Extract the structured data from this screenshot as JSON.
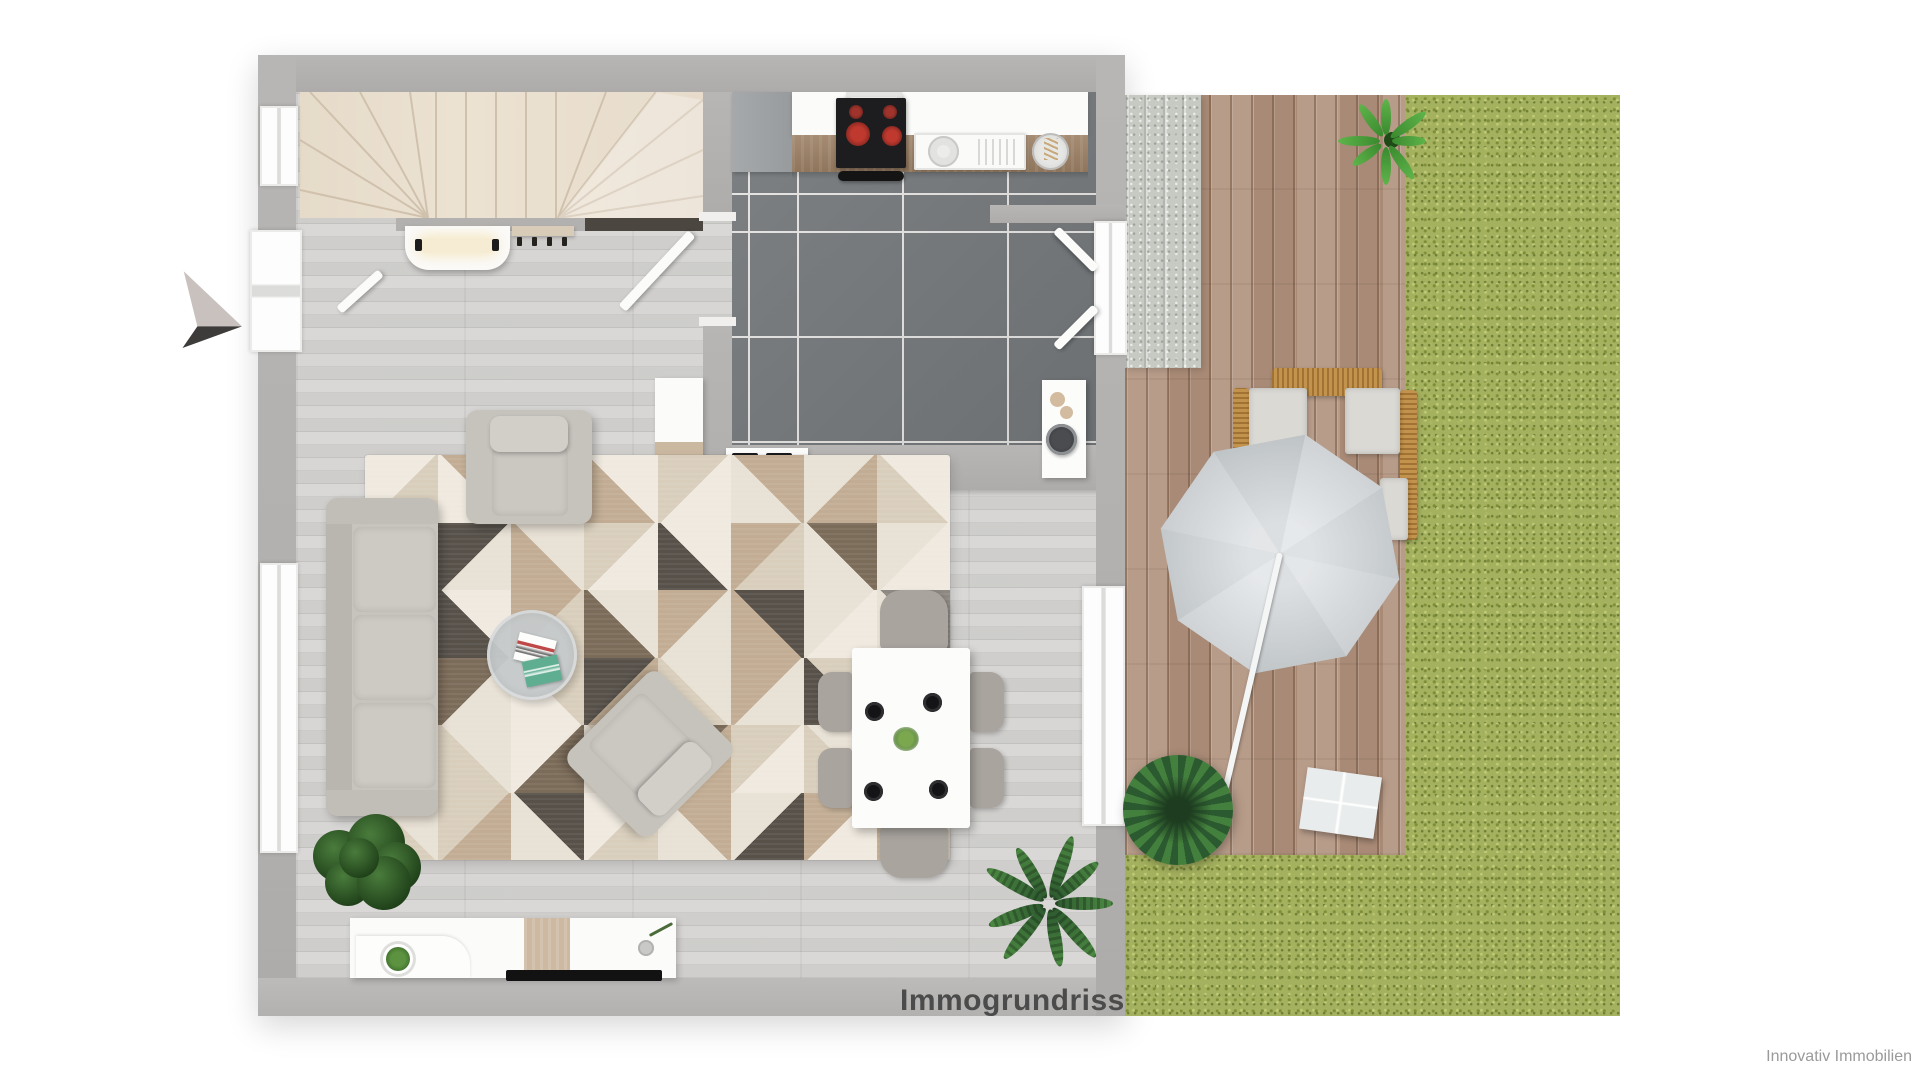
{
  "watermark": {
    "label": "Immogrundriss",
    "color": "#4b4b4b"
  },
  "branding": {
    "label": "Innovativ Immobilien",
    "color": "#9a9a9a"
  },
  "palette": {
    "wall": "#b4b2b0",
    "wood_floor": "#d7d6d4",
    "tile_floor": "#75797c",
    "stair": "#e8ddcc",
    "deck_wood": "#b29480",
    "grass": "#a4b15e",
    "kitchen_counter": "#9b7f63",
    "sofa": "#c7c3bd",
    "umbrella": "#d3d8da",
    "rattan": "#c2934d",
    "burner_red": "#c0392f",
    "plant_dark_green": "#2c5a30",
    "plant_light_green": "#5fb44b"
  },
  "rug": {
    "cols": 8,
    "rows": 6,
    "cell_w": 73.125,
    "cell_h": 67.5,
    "palette": [
      "#e8e1d5",
      "#d9cebc",
      "#c2ad94",
      "#a3937e",
      "#8f8983",
      "#57514a",
      "#7b6b59",
      "#efe9df"
    ],
    "pattern": [
      [
        [
          1,
          7,
          0
        ],
        [
          7,
          2,
          1
        ],
        [
          0,
          3,
          0
        ],
        [
          2,
          7,
          1
        ],
        [
          7,
          1,
          0
        ],
        [
          0,
          2,
          1
        ],
        [
          2,
          0,
          0
        ],
        [
          1,
          7,
          1
        ]
      ],
      [
        [
          7,
          4,
          1
        ],
        [
          0,
          5,
          0
        ],
        [
          2,
          0,
          1
        ],
        [
          7,
          1,
          0
        ],
        [
          5,
          7,
          1
        ],
        [
          1,
          2,
          0
        ],
        [
          0,
          6,
          1
        ],
        [
          7,
          0,
          0
        ]
      ],
      [
        [
          0,
          1,
          0
        ],
        [
          5,
          7,
          1
        ],
        [
          1,
          2,
          0
        ],
        [
          6,
          0,
          1
        ],
        [
          0,
          2,
          0
        ],
        [
          2,
          5,
          1
        ],
        [
          7,
          0,
          0
        ],
        [
          0,
          4,
          1
        ]
      ],
      [
        [
          2,
          7,
          1
        ],
        [
          0,
          6,
          0
        ],
        [
          7,
          1,
          1
        ],
        [
          2,
          5,
          0
        ],
        [
          1,
          0,
          1
        ],
        [
          0,
          2,
          0
        ],
        [
          5,
          1,
          1
        ],
        [
          1,
          2,
          0
        ]
      ],
      [
        [
          0,
          5,
          0
        ],
        [
          1,
          0,
          1
        ],
        [
          6,
          7,
          0
        ],
        [
          0,
          1,
          1
        ],
        [
          2,
          6,
          0
        ],
        [
          7,
          1,
          0
        ],
        [
          1,
          0,
          1
        ],
        [
          0,
          5,
          0
        ]
      ],
      [
        [
          1,
          0,
          1
        ],
        [
          2,
          1,
          0
        ],
        [
          0,
          5,
          1
        ],
        [
          1,
          7,
          0
        ],
        [
          0,
          2,
          1
        ],
        [
          5,
          0,
          0
        ],
        [
          7,
          2,
          0
        ],
        [
          2,
          1,
          1
        ]
      ]
    ]
  }
}
